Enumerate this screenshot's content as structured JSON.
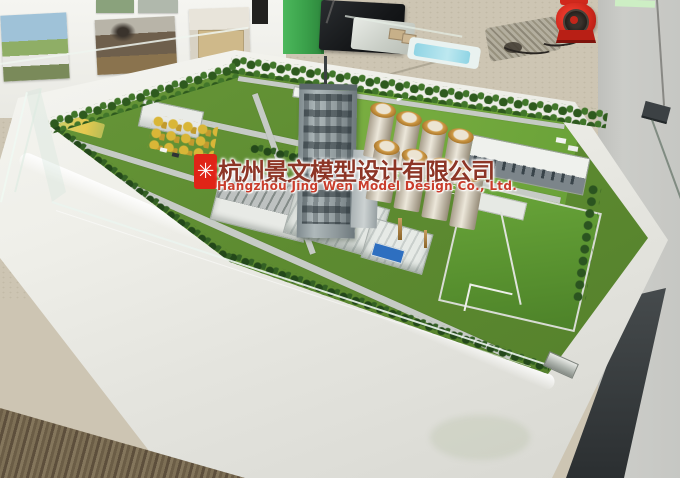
{
  "scene": {
    "kind": "photograph",
    "subject": "architectural scale model of an industrial plant on a white display table"
  },
  "watermark": {
    "logo_glyph": "✳",
    "company_cn": "杭州景文模型设计有限公司",
    "company_en": "Hangzhou Jing Wen Model Design Co., Ltd."
  },
  "colors": {
    "watermark_logo_red": "#e02417",
    "watermark_cn_text": "#8d3526",
    "watermark_en_text": "#c93d2c",
    "table_white": "#ededе7",
    "model_green": "#5e8c31",
    "field_green": "#76ab3c",
    "fan_red": "#d0281c",
    "pillar_green": "#3aa04a",
    "carpet_beige": "#cdc5b3",
    "carpet_brown": "#77684f",
    "wall_gray": "#c8c9c5",
    "dark_pillar": "#34383a"
  }
}
